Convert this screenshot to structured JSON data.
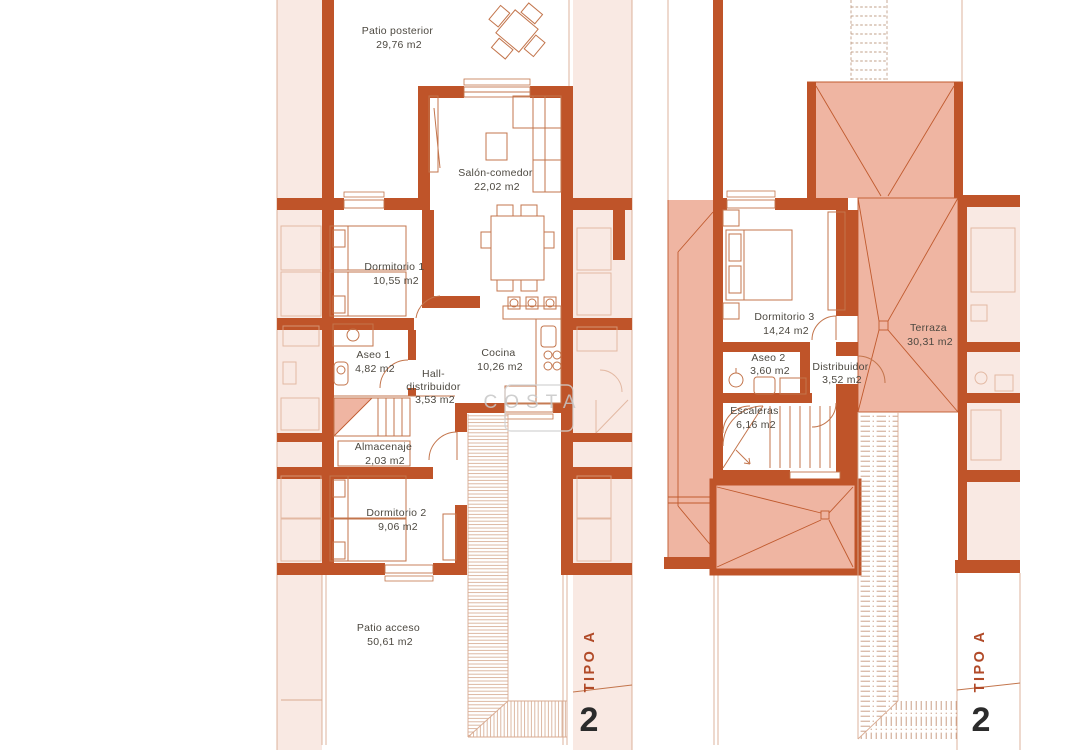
{
  "document": {
    "sheet_type": "floor-plan",
    "unit_type": "TIPO A",
    "unit_number": "2"
  },
  "watermark": {
    "text": "COSTA"
  },
  "palette": {
    "wall": "#bf5429",
    "roof_fill": "#efb5a2",
    "roof_line": "#c05a2e",
    "neighbor_band": "#f9e9e3",
    "furniture_line": "#c3754c",
    "hatch_line": "#c99e7e",
    "label_text": "#4c4840",
    "tipo_red": "#b14a28",
    "number_dark": "#2b2b2b",
    "watermark_gray": "#c7c7c7"
  },
  "left": {
    "floor": "planta baja",
    "rooms": [
      {
        "id": "patio-posterior",
        "name": "Patio posterior",
        "area": "29,76 m2"
      },
      {
        "id": "salon-comedor",
        "name": "Salón-comedor",
        "area": "22,02 m2"
      },
      {
        "id": "dormitorio-1",
        "name": "Dormitorio 1",
        "area": "10,55 m2"
      },
      {
        "id": "aseo-1",
        "name": "Aseo 1",
        "area": "4,82 m2"
      },
      {
        "id": "hall-distribuidor",
        "name": "Hall-",
        "name2": "distribuidor",
        "area": "3,53 m2"
      },
      {
        "id": "cocina",
        "name": "Cocina",
        "area": "10,26 m2"
      },
      {
        "id": "almacenaje",
        "name": "Almacenaje",
        "area": "2,03 m2"
      },
      {
        "id": "dormitorio-2",
        "name": "Dormitorio 2",
        "area": "9,06 m2"
      },
      {
        "id": "patio-acceso",
        "name": "Patio acceso",
        "area": "50,61 m2"
      }
    ],
    "tipo": "TIPO A",
    "number": "2"
  },
  "right": {
    "floor": "planta primera",
    "rooms": [
      {
        "id": "dormitorio-3",
        "name": "Dormitorio 3",
        "area": "14,24 m2"
      },
      {
        "id": "aseo-2",
        "name": "Aseo 2",
        "area": "3,60 m2"
      },
      {
        "id": "distribuidor",
        "name": "Distribuidor",
        "area": "3,52 m2"
      },
      {
        "id": "escaleras",
        "name": "Escaleras",
        "area": "6,16 m2"
      },
      {
        "id": "terraza",
        "name": "Terraza",
        "area": "30,31 m2"
      }
    ],
    "tipo": "TIPO A",
    "number": "2"
  }
}
